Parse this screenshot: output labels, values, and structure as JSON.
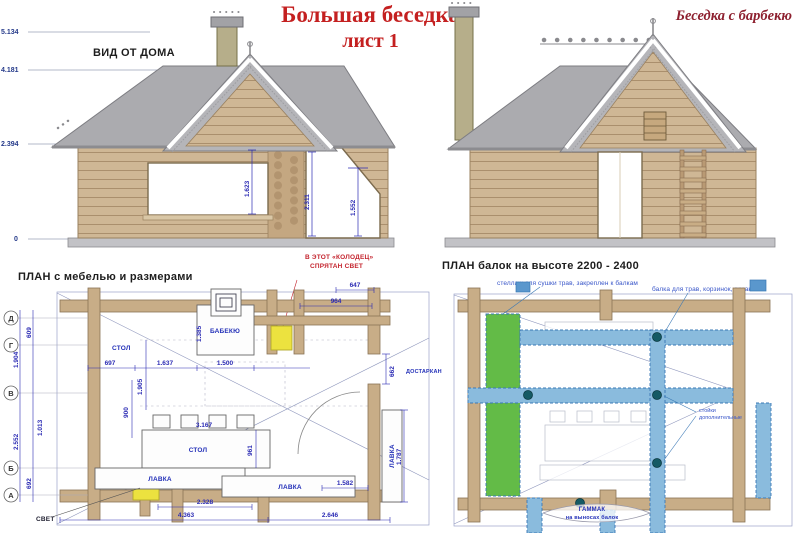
{
  "header": {
    "title_line1": "Большая беседка",
    "title_line2": "лист 1",
    "corner_title": "Беседка с барбекю"
  },
  "colors": {
    "title_red": "#c42020",
    "corner_red": "#8e2130",
    "dim_blue": "#2b2bb4",
    "note_blue": "#3956c9",
    "annotation_red": "#c4242e",
    "roof_gray": "#ababaf",
    "log_tan": "#cfb795",
    "wall_tan": "#c8ad87",
    "beam_blue": "#8abbdd",
    "shelf_green": "#63bb47",
    "light_yellow": "#ece23f"
  },
  "elevation_left": {
    "label": "ВИД ОТ ДОМА",
    "marks": {
      "m0": "5.134",
      "m1": "4.181",
      "m2": "2.394",
      "m3": "0"
    },
    "dims": {
      "d1": "1.623",
      "d2": "2.311",
      "d3": "1.552"
    }
  },
  "plan_left": {
    "title": "ПЛАН  с мебелью и размерами",
    "well_note_line1": "В ЭТОТ «КОЛОДЕЦ»",
    "well_note_line2": "СПРЯТАН СВЕТ",
    "light_label": "СВЕТ",
    "axis": {
      "a0": "Д",
      "a1": "Г",
      "a2": "В",
      "a3": "Б",
      "a4": "А"
    },
    "furniture": {
      "table_small": "СТОЛ",
      "barbecue": "БАБЕКЮ",
      "table_main": "СТОЛ",
      "bench1": "ЛАВКА",
      "bench2": "ЛАВКА",
      "bench3": "ЛАВКА",
      "serving": "ДОСТАРКАН"
    },
    "dims": {
      "top647": "647",
      "top964": "964",
      "h1385": "1.385",
      "w697": "697",
      "w1637": "1.637",
      "w1500": "1.500",
      "w662": "662",
      "v900": "900",
      "v1905": "1.905",
      "t3167": "3.167",
      "t961": "961",
      "v1787": "1.787",
      "l609": "609",
      "l1904": "1.904",
      "l2552": "2.552",
      "l692": "692",
      "l1013": "1.013",
      "b1582": "1.582",
      "b2328": "2.328",
      "b4363": "4.363",
      "b2646": "2.646"
    }
  },
  "plan_right": {
    "title": "ПЛАН  балок на высоте 2200 - 2400",
    "note_shelf": "стеллаж для сушки трав, закреплен к балкам",
    "note_beam": "балка для трав, корзинок, вязанок",
    "note_posts_line1": "стойки",
    "note_posts_line2": "дополнительные",
    "hammock_line1": "ГАММАК",
    "hammock_line2": "на выносах балок"
  }
}
